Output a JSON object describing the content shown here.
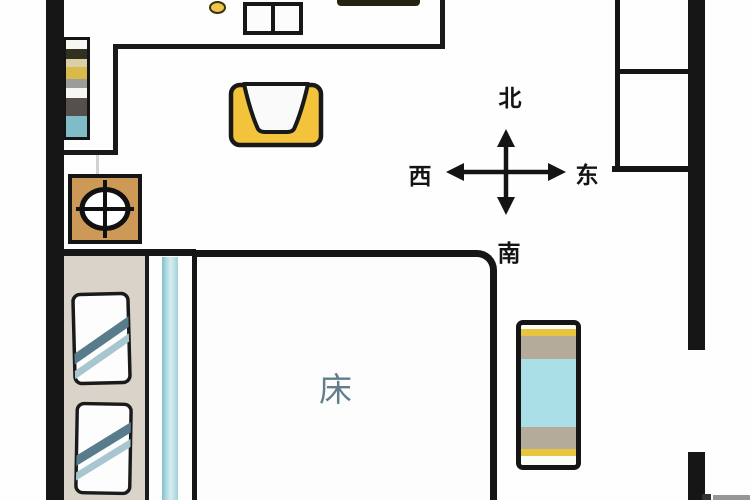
{
  "diagram": {
    "type": "bedroom-floor-plan",
    "room_label": {
      "bed": "床"
    },
    "compass": {
      "north": "北",
      "south": "南",
      "west": "西",
      "east": "东"
    }
  },
  "furniture_icons": [
    "striped-bookshelf-icon",
    "round-stool-icon",
    "two-drawer-table-icon",
    "armchair-icon",
    "stove-burner-icon",
    "double-bed-icon",
    "pillow-icon",
    "striped-bench-icon",
    "wardrobe-icon"
  ],
  "colors": {
    "wall": "#161616",
    "armchair_yellow": "#f3c33c",
    "stove_cabinet_tan": "#cd9957",
    "bench_cyan": "#abdfe7",
    "bench_taupe": "#b5ab9b",
    "bench_yellow": "#e7c53f",
    "headboard_beige": "#d9d3c9",
    "bed_runner_teal": "#8cc3cf",
    "shelf_teal": "#7fbcc8",
    "shelf_yellow": "#d9b94a",
    "pillow_stripe_dark": "#587c8c",
    "pillow_stripe_light": "#a7c6d0",
    "bed_label_color": "#627e8c"
  }
}
